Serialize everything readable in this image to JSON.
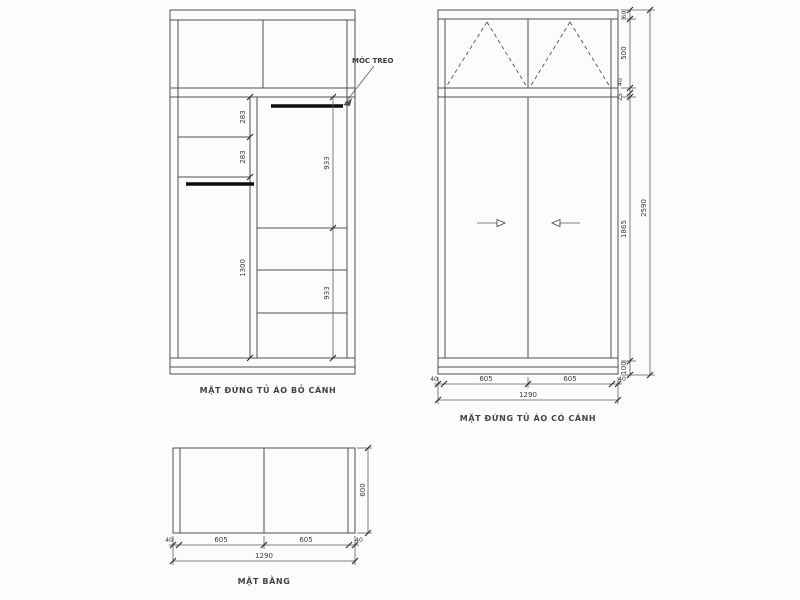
{
  "colors": {
    "background": "#fcfcfc",
    "line": "#4f4f4f",
    "hanger_rod": "#0d0d0d",
    "text": "#3c3c3c"
  },
  "views": {
    "left": {
      "caption": "MẶT ĐỨNG TỦ ÁO BỎ CÁNH",
      "hanger_label": "MÓC TREO",
      "dim_upper_shelf": "283",
      "dim_lower_shelf": "283",
      "dim_left_section": "1300",
      "dim_right_top_section": "933",
      "dim_right_bottom_section": "933"
    },
    "right": {
      "caption": "MẶT ĐỨNG TỦ ÁO CÓ CÁNH",
      "dim_top_rail": "60",
      "dim_top_cabinet": "500",
      "dim_shelf_thickness": "40",
      "dim_gap": "25",
      "dim_door_height": "1865",
      "dim_base_height": "100",
      "dim_total_height": "2590",
      "dim_bottom_chain": [
        "40",
        "605",
        "605",
        "40"
      ],
      "dim_total_width": "1290"
    },
    "plan": {
      "caption": "MẶT BẰNG",
      "dim_depth": "600",
      "dim_bottom_chain": [
        "40",
        "605",
        "605",
        "40"
      ],
      "dim_total_width": "1290"
    }
  }
}
